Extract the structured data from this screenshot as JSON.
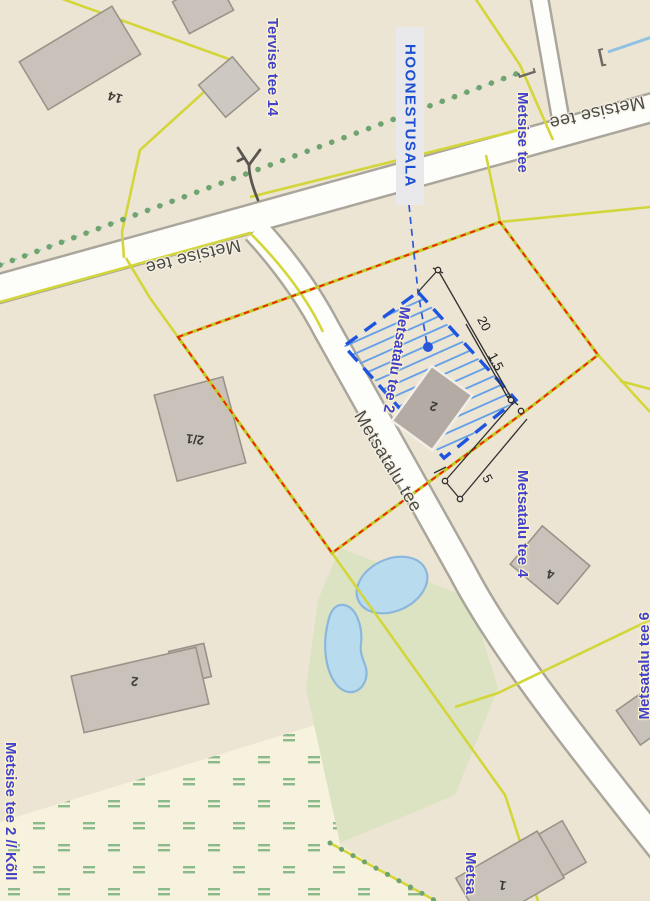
{
  "map": {
    "area_label": "HOONESTUSALA",
    "roads": {
      "metsise_tee": "Metsise tee",
      "metsatalu_tee": "Metsatalu tee"
    },
    "addresses": {
      "tervise_tee_14": "Tervise tee 14",
      "metsise_tee_blue": "Metsise tee",
      "metsatalu_tee_2": "Metsatalu tee 2",
      "metsatalu_tee_4": "Metsatalu tee 4",
      "metsatalu_tee_6": "Metsatalu tee 6",
      "metsise_tee_2_koll": "Metsise tee 2 // Kõll",
      "metsa_partial": "Metsa"
    },
    "building_numbers": {
      "b14": "14",
      "b2_1": "2/1",
      "b2_highlighted": "2",
      "b2_big": "2",
      "b4": "4",
      "b1": "1"
    },
    "dimensions": {
      "d20": "20",
      "d1_5": "1.5",
      "d5": "5"
    },
    "colors": {
      "base": "#ede5d3",
      "wetland": "#f6f2dd",
      "green_area": "#dbe3c2",
      "pond_fill": "#b9dbee",
      "pond_stroke": "#8bb7dd",
      "parcel_yellow": "#d3d63b",
      "boundary_red": "#ef2109",
      "building_fill": "#c9c2bb",
      "hatch_blue": "#1d55e0",
      "hatch_line": "#5f9de8",
      "label_blue": "#4341c9",
      "hoonestusala_blue": "#1c4fd1"
    }
  }
}
